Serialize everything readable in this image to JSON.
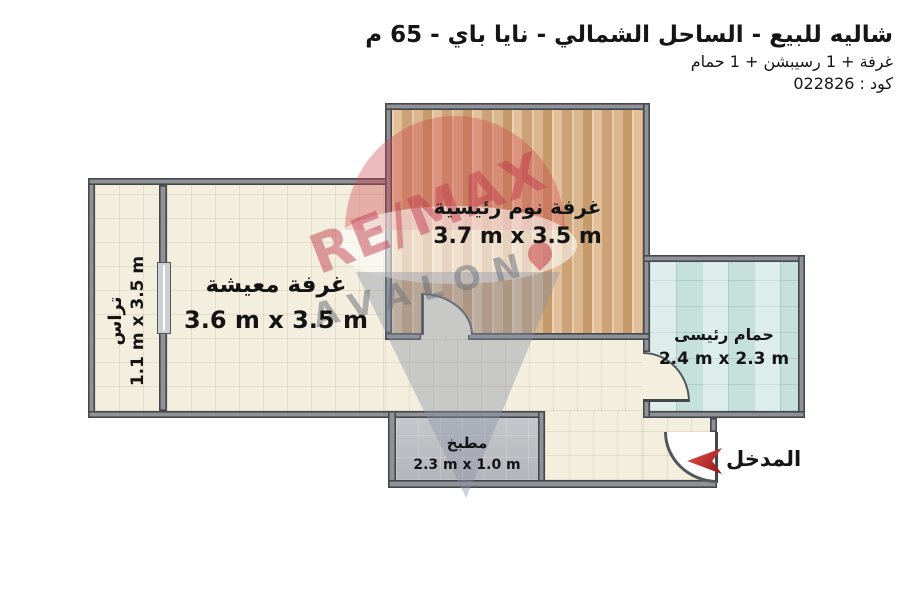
{
  "header": {
    "title": "شاليه للبيع - الساحل الشمالي - نايا باي - 65 م",
    "subtitle": "غرفة + 1 رسيبشن + 1 حمام",
    "code": "كود : 022826"
  },
  "rooms": {
    "bedroom": {
      "name": "غرفة نوم رئيسية",
      "dims": "3.7 m x 3.5 m"
    },
    "living": {
      "name": "غرفة معيشة",
      "dims": "3.6 m x 3.5 m"
    },
    "terrace": {
      "name": "تراس",
      "dims": "1.1 m x 3.5 m"
    },
    "bathroom": {
      "name": "حمام رئيسى",
      "dims": "2.4 m x 2.3 m"
    },
    "kitchen": {
      "name": "مطبخ",
      "dims": "2.3 m x 1.0 m"
    }
  },
  "entrance": {
    "label": "المدخل"
  },
  "watermark": {
    "brand": "RE/MAX",
    "sub": "AVALON"
  },
  "colors": {
    "wall": "#55575d",
    "floor_cream": "#f3eede",
    "floor_wood": "#d8b28a",
    "floor_bathroom": "#cfe6e1",
    "floor_kitchen": "#bbbcc0",
    "entrance_arrow_red": "#c62828",
    "watermark_red": "#c0394a",
    "watermark_gray": "#8792a6",
    "text": "#151515"
  }
}
